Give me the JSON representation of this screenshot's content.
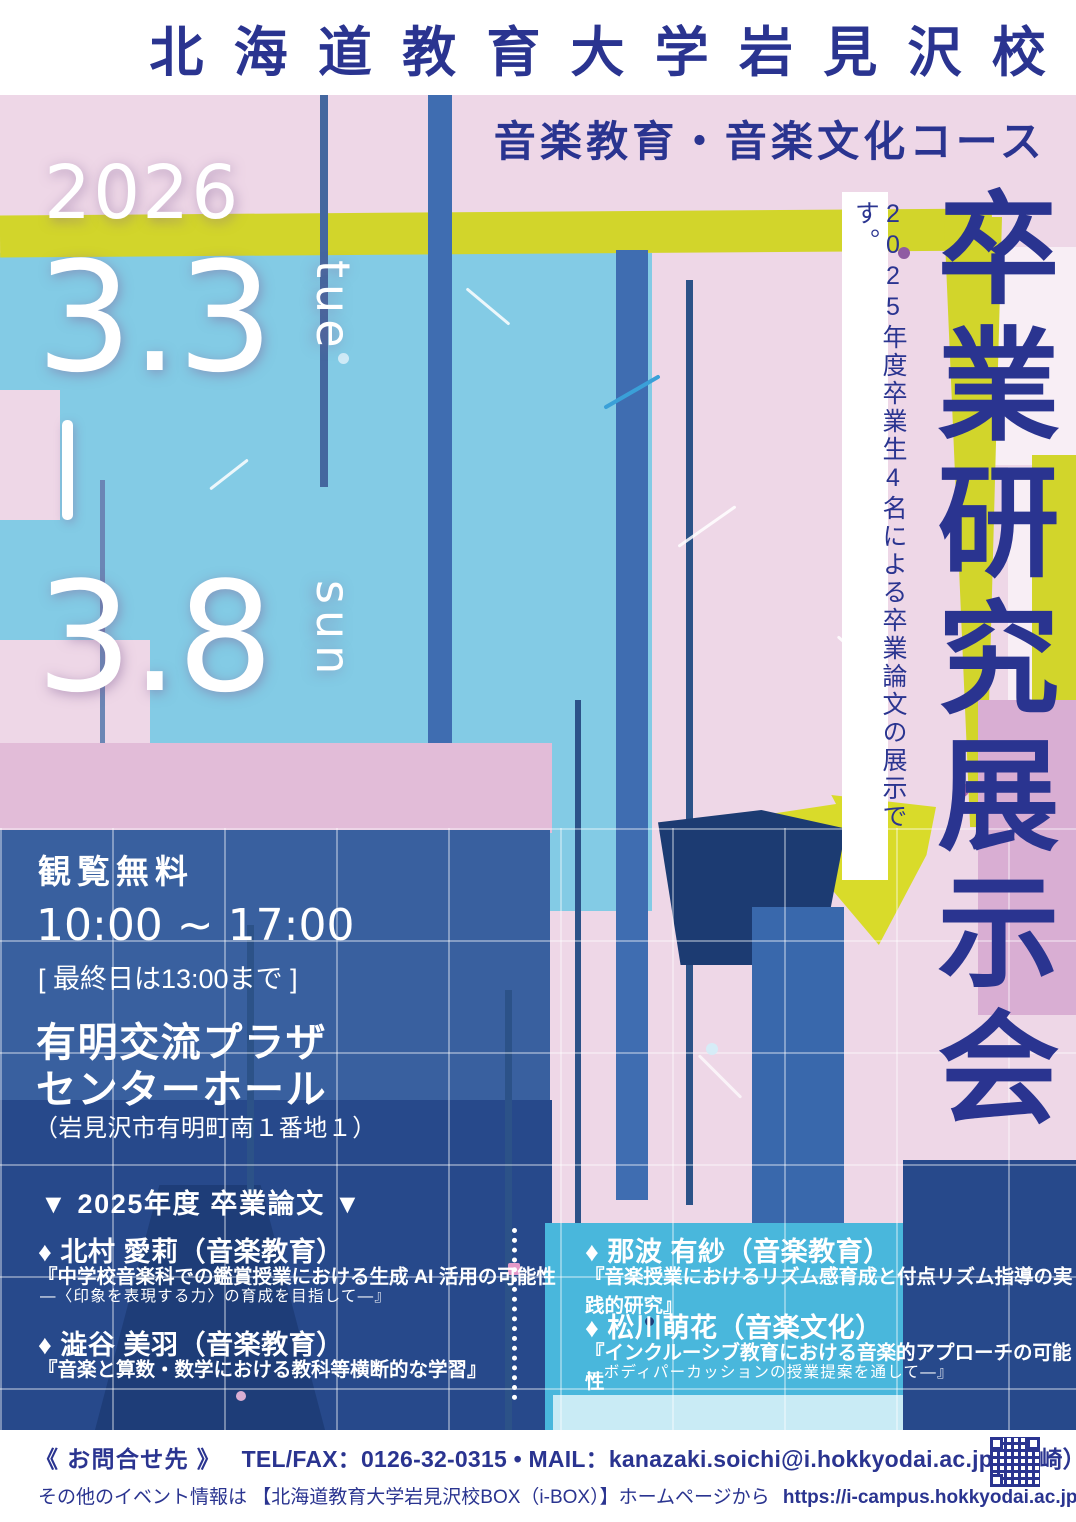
{
  "colors": {
    "navy_text": "#2a3490",
    "accent_yellow": "#d2d52b",
    "base_pink": "#eed7e7",
    "light_blue": "#83cbe5",
    "denim_blue": "#39609f",
    "dark_navy": "#1c3b72",
    "cyan": "#49b7dc",
    "mauve": "#d9aed3",
    "white": "#ffffff"
  },
  "header": {
    "university": "北海道教育大学岩見沢校",
    "course": "音楽教育・音楽文化コース"
  },
  "date": {
    "year": "2026",
    "start_date": "3.3",
    "start_day": "tue",
    "range_separator": "—",
    "end_date": "3.8",
    "end_day": "sun"
  },
  "title": {
    "main_vertical": "卒業研究展示会",
    "side_note": "2025年度卒業生4名による卒業論文の展示です。"
  },
  "info": {
    "admission": "観覧無料",
    "hours": "10:00 ~ 17:00",
    "hours_note": "[ 最終日は13:00まで ]",
    "venue_line1": "有明交流プラザ",
    "venue_line2": "センターホール",
    "address": "（岩見沢市有明町南１番地１）"
  },
  "theses": {
    "header": "▼ 2025年度 卒業論文 ▼",
    "items": [
      {
        "name": "♦ 北村 愛莉（音楽教育）",
        "title": "『中学校音楽科での鑑賞授業における生成 AI 活用の可能性",
        "subtitle": "―〈印象を表現する力〉の育成を目指して―』"
      },
      {
        "name": "♦ 澁谷 美羽（音楽教育）",
        "title": "『音楽と算数・数学における教科等横断的な学習』",
        "subtitle": ""
      },
      {
        "name": "♦ 那波 有紗（音楽教育）",
        "title": "『音楽授業におけるリズム感育成と付点リズム指導の実践的研究』",
        "subtitle": ""
      },
      {
        "name": "♦ 松川萌花（音楽文化）",
        "title": "『インクルーシブ教育における音楽的アプローチの可能性",
        "subtitle": "―ボディパーカッションの授業提案を通して―』"
      }
    ]
  },
  "footer": {
    "contact_label": "《 お問合せ先 》",
    "tel_mail": "TEL/FAX：0126-32-0315 • MAIL：kanazaki.soichi@i.hokkyodai.ac.jp（金崎）",
    "events_info": "その他のイベント情報は 【北海道教育大学岩見沢校BOX（i-BOX）】ホームページから",
    "url": "https://i-campus.hokkyodai.ac.jp/i-box ▶"
  }
}
